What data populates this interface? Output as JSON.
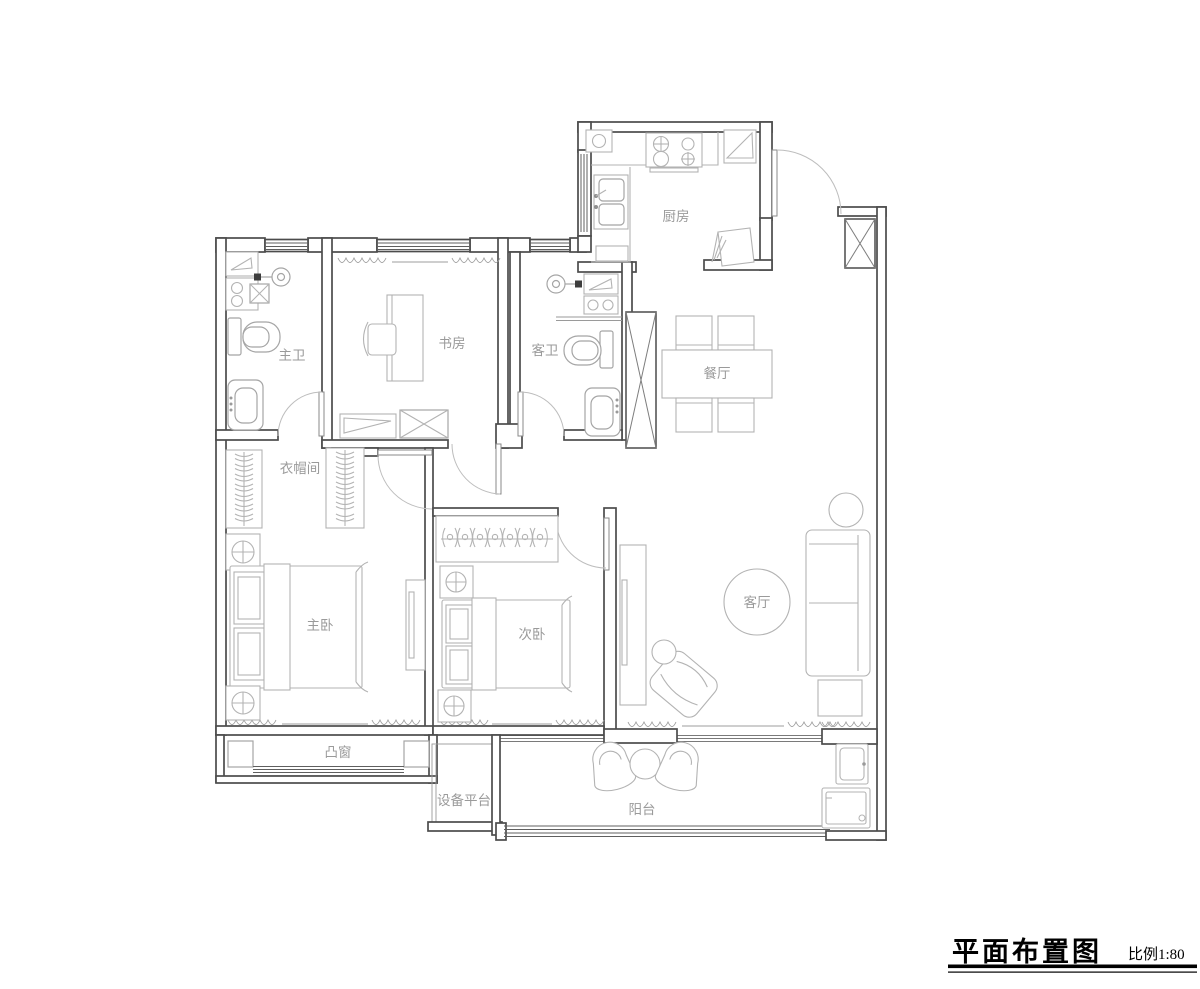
{
  "drawing": {
    "title": "平面布置图",
    "scale_label": "比例1:80"
  },
  "rooms": {
    "master_bath": {
      "label": "主卫"
    },
    "study": {
      "label": "书房"
    },
    "guest_bath": {
      "label": "客卫"
    },
    "kitchen": {
      "label": "厨房"
    },
    "dining": {
      "label": "餐厅"
    },
    "cloak_room": {
      "label": "衣帽间"
    },
    "master_bedroom": {
      "label": "主卧"
    },
    "second_bedroom": {
      "label": "次卧"
    },
    "living_room": {
      "label": "客厅"
    },
    "bay_window": {
      "label": "凸窗"
    },
    "equipment_platform": {
      "label": "设备平台"
    },
    "balcony": {
      "label": "阳台"
    }
  }
}
